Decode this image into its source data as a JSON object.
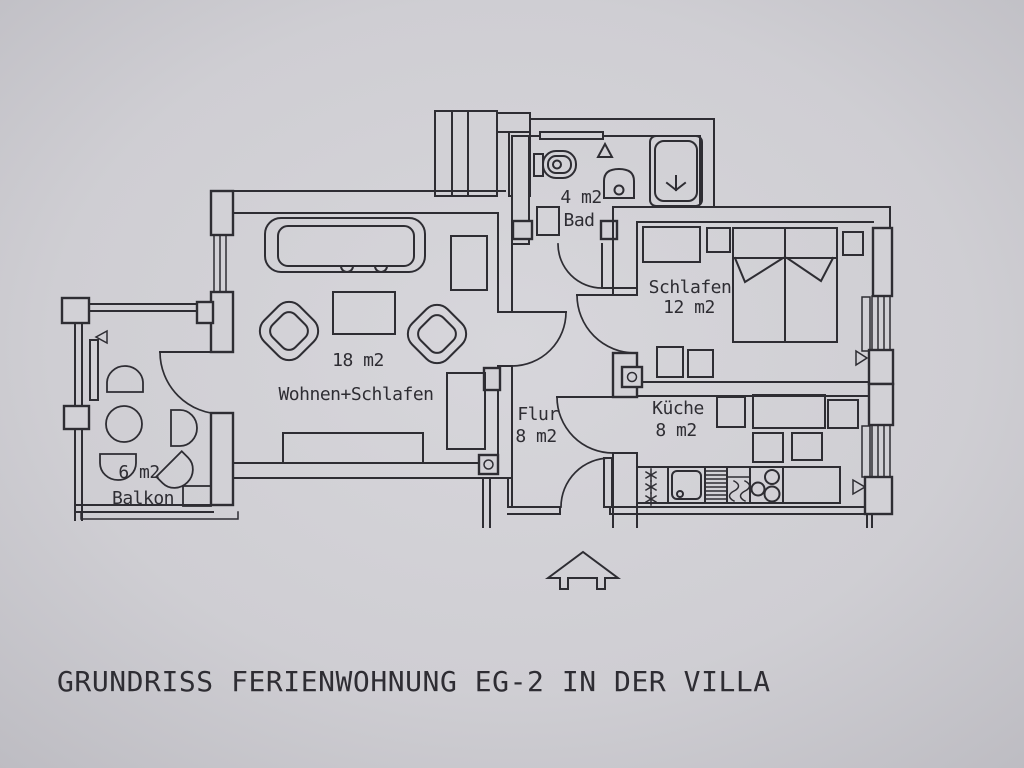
{
  "title": "GRUNDRISS FERIENWOHNUNG EG-2 IN DER VILLA",
  "rooms": {
    "bad": {
      "area_label": "4 m2",
      "name": "Bad"
    },
    "schlafen": {
      "name": "Schlafen",
      "area_label": "12 m2"
    },
    "wohnen_schlafen": {
      "area_label": "18 m2",
      "name": "Wohnen+Schlafen"
    },
    "flur": {
      "name": "Flur",
      "area_label": "8 m2"
    },
    "kueche": {
      "name": "Küche",
      "area_label": "8 m2"
    },
    "balkon": {
      "area_label": "6 m2",
      "name": "Balkon"
    }
  },
  "colors": {
    "paper": "#d2d1d6",
    "ink": "#2e2d33"
  }
}
